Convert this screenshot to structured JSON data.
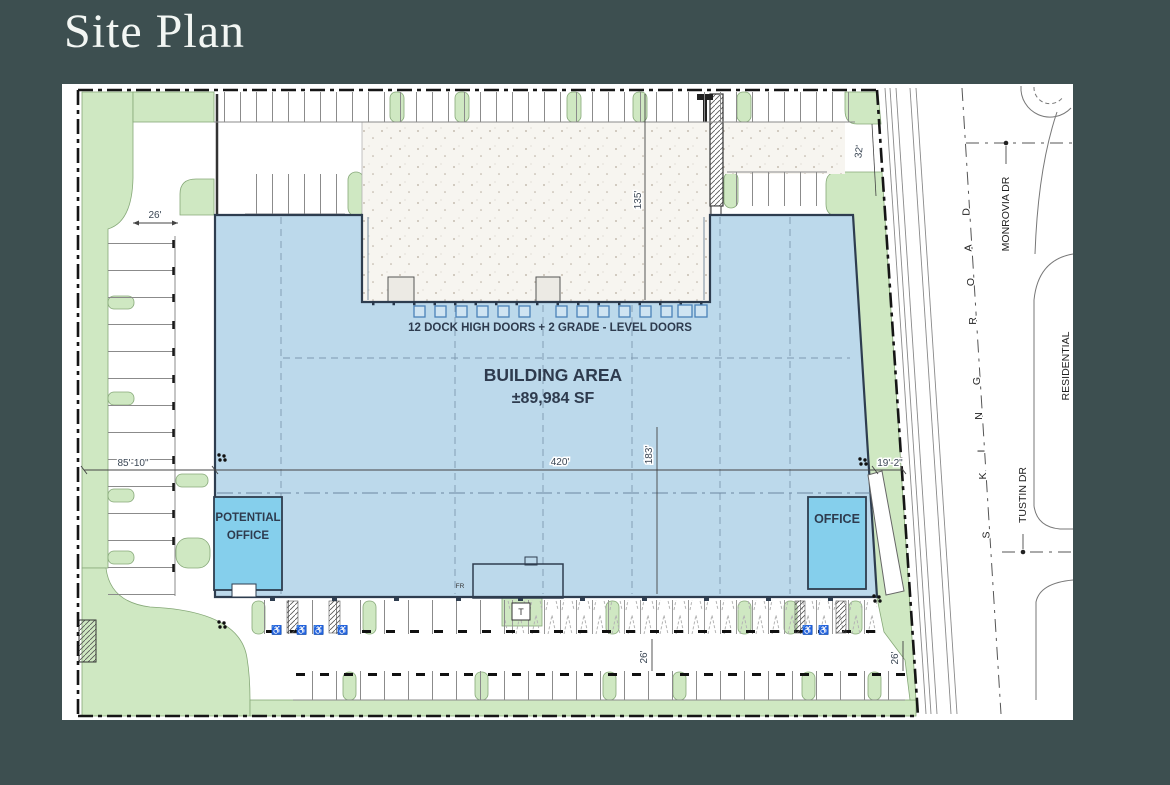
{
  "page": {
    "title": "Site Plan"
  },
  "theme": {
    "background": "#3d4f50",
    "panel": "#ffffff",
    "building_fill": "#bcd9eb",
    "office_fill": "#85cfec",
    "landscape_green": "#cfe8c2",
    "ink": "#2e3d4f",
    "dock_door_blue": "#4a82b8"
  },
  "building": {
    "area_line1": "BUILDING AREA",
    "area_line2": "±89,984 SF",
    "dock_label": "12 DOCK HIGH DOORS + 2 GRADE - LEVEL DOORS",
    "potential_office_line1": "POTENTIAL",
    "potential_office_line2": "OFFICE",
    "office_label": "OFFICE",
    "transformer_label": "T",
    "fire_riser_label": "FR"
  },
  "dimensions": {
    "northwest_aisle": "26'",
    "west_yard": "85'-10\"",
    "building_width": "420'",
    "building_depth": "183'",
    "truck_court_depth": "135'",
    "northeast_frontage": "32'",
    "east_setback": "19'-2\"",
    "south_aisle_west": "26'",
    "south_aisle_east": "26'"
  },
  "streets": {
    "king_road_letters": [
      "D",
      "A",
      "O",
      "R",
      "G",
      "N",
      "I",
      "K",
      "S"
    ],
    "monrovia": "MONROVIA DR",
    "tustin": "TUSTIN DR",
    "residential": "RESIDENTIAL"
  },
  "symbols": {
    "accessible": "♿"
  }
}
